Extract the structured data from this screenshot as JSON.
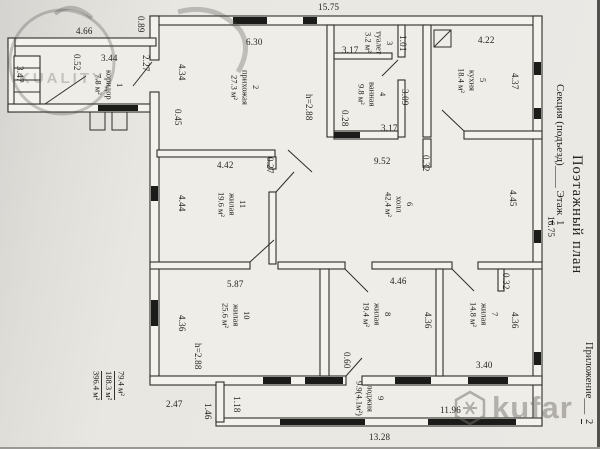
{
  "sheet": {
    "plan_title": "Поэтажный план",
    "section_label": "Секция (подъезд)",
    "section_blank": "____",
    "floor_label": "Этаж",
    "floor_value": "1",
    "appendix_label": "Приложение",
    "appendix_blank": "___",
    "appendix_value": "2",
    "right_dim": "16.75"
  },
  "area_summary": {
    "value1": "79.4 м²",
    "value2": "188.3 м²",
    "value3": "396.4 м²"
  },
  "watermarks": {
    "left_text": "KUALITY",
    "right_text": "kufar"
  },
  "rooms": [
    {
      "num": "1",
      "name": "коридор",
      "area": "7.8 м²"
    },
    {
      "num": "2",
      "name": "прихожая",
      "area": "27.3 м²"
    },
    {
      "num": "3",
      "name": "туалет",
      "area": "3.2 м²"
    },
    {
      "num": "4",
      "name": "ванная",
      "area": "9.8 м²"
    },
    {
      "num": "5",
      "name": "кухня",
      "area": "18.4 м²"
    },
    {
      "num": "6",
      "name": "холл",
      "area": "42.4 м²"
    },
    {
      "num": "7",
      "name": "жилая",
      "area": "14.8 м²"
    },
    {
      "num": "8",
      "name": "жилая",
      "area": "19.4 м²"
    },
    {
      "num": "9",
      "name": "лоджия",
      "area": "9.9(4.1м²)"
    },
    {
      "num": "10",
      "name": "жилая",
      "area": "25.6 м²"
    },
    {
      "num": "11",
      "name": "жилая",
      "area": "19.6 м²"
    }
  ],
  "dims": {
    "top": "15.75",
    "corrTop": "4.66",
    "s089": "0.89",
    "prih630": "6.30",
    "corr344": "3.44",
    "corr052": "0.52",
    "corr227": "2.27",
    "corr347": "3.47",
    "prih434": "4.34",
    "prih045": "0.45",
    "wc317": "3.17",
    "wc101": "1.01",
    "kit422": "4.22",
    "kit437": "4.37",
    "bath309": "3.09",
    "bath028": "0.28",
    "bath317": "3.17",
    "h288a": "h=2.88",
    "hall952": "9.52",
    "hall032": "0.32",
    "r11_442": "4.42",
    "r11_027": "0.27",
    "r11_444": "4.44",
    "hall445": "4.45",
    "r10_587": "5.87",
    "r10_436": "4.36",
    "h288b": "h=2.88",
    "r8_446": "4.46",
    "r8_436": "4.36",
    "d060": "0.60",
    "r7_032": "0.32",
    "r7_436": "4.36",
    "r7_340": "3.40",
    "d247": "2.47",
    "d146": "1.46",
    "d118": "1.18",
    "d1196": "11.96",
    "d1328": "13.28"
  }
}
